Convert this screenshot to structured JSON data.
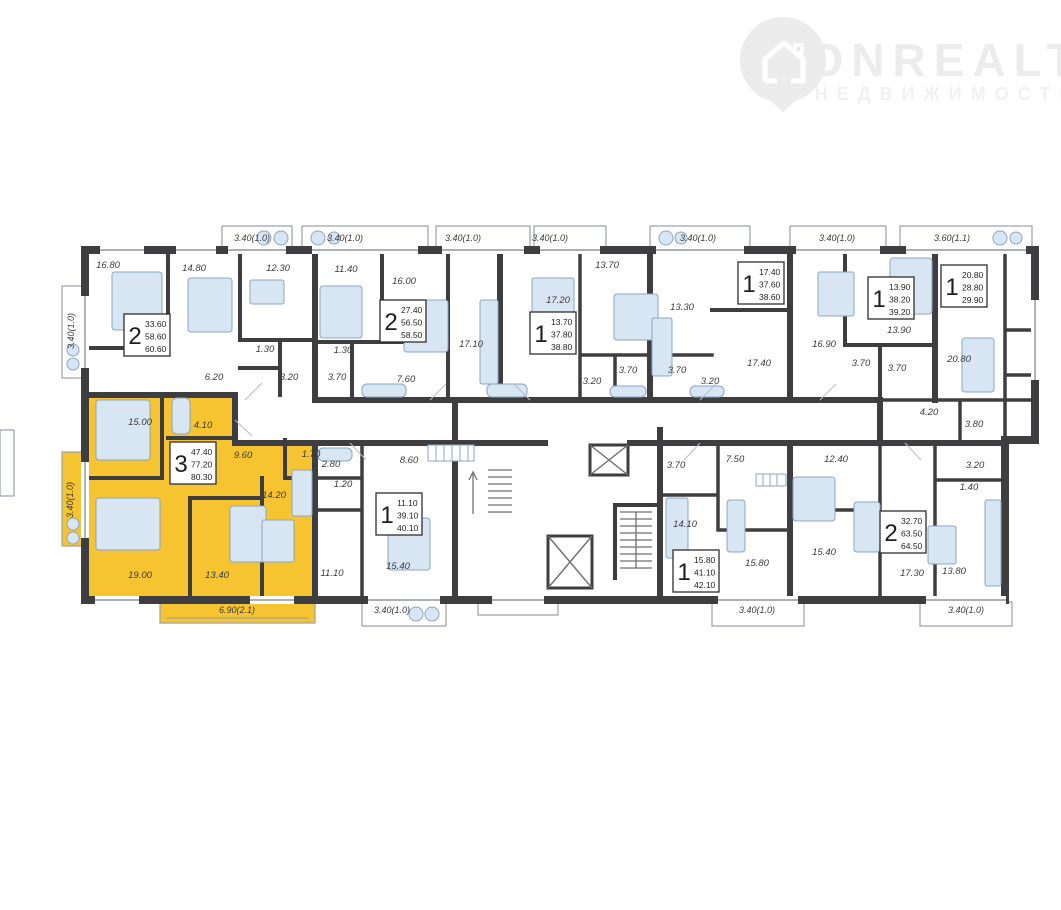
{
  "watermark": {
    "brand": "ONREALT",
    "subtitle": "НЕДВИЖИМОСТЬ",
    "icon": "house-pin-icon"
  },
  "palette": {
    "highlight": "#f6c331",
    "wall": "#3e3e40",
    "furniture_fill": "#d8e6f3",
    "furniture_stroke": "#8ba6c1",
    "label_color": "#3a3a3a",
    "watermark_color": "#ececec"
  },
  "highlighted_apartment": {
    "rooms": "3",
    "area_living": "47.40",
    "area_usable": "77.20",
    "area_total": "80.30",
    "balcony_dimension": "6.90(2.1)"
  },
  "apartment_tags": [
    {
      "n": "2",
      "a1": "33.60",
      "a2": "58.60",
      "a3": "60.60",
      "x": 124,
      "y": 314,
      "hl": false
    },
    {
      "n": "2",
      "a1": "27.40",
      "a2": "56.50",
      "a3": "58.50",
      "x": 380,
      "y": 300,
      "hl": false
    },
    {
      "n": "1",
      "a1": "13.70",
      "a2": "37.80",
      "a3": "38.80",
      "x": 530,
      "y": 312,
      "hl": false
    },
    {
      "n": "1",
      "a1": "17.40",
      "a2": "37.60",
      "a3": "38.60",
      "x": 738,
      "y": 262,
      "hl": false
    },
    {
      "n": "1",
      "a1": "13.90",
      "a2": "38.20",
      "a3": "39.20",
      "x": 868,
      "y": 277,
      "hl": false
    },
    {
      "n": "1",
      "a1": "20.80",
      "a2": "28.80",
      "a3": "29.90",
      "x": 941,
      "y": 265,
      "hl": false
    },
    {
      "n": "3",
      "a1": "47.40",
      "a2": "77.20",
      "a3": "80.30",
      "x": 170,
      "y": 442,
      "hl": true
    },
    {
      "n": "1",
      "a1": "11.10",
      "a2": "39.10",
      "a3": "40.10",
      "x": 376,
      "y": 493,
      "hl": false
    },
    {
      "n": "1",
      "a1": "15.80",
      "a2": "41.10",
      "a3": "42.10",
      "x": 673,
      "y": 550,
      "hl": false
    },
    {
      "n": "2",
      "a1": "32.70",
      "a2": "63.50",
      "a3": "64.50",
      "x": 880,
      "y": 511,
      "hl": false
    }
  ],
  "room_labels": [
    [
      "16.80",
      108,
      268
    ],
    [
      "14.80",
      194,
      271
    ],
    [
      "12.30",
      278,
      271
    ],
    [
      "11.40",
      346,
      272
    ],
    [
      "16.00",
      404,
      284
    ],
    [
      "17.10",
      471,
      347
    ],
    [
      "17.20",
      558,
      303
    ],
    [
      "13.70",
      607,
      268
    ],
    [
      "13.30",
      682,
      310
    ],
    [
      "17.40",
      759,
      366
    ],
    [
      "16.90",
      824,
      347
    ],
    [
      "13.90",
      899,
      333
    ],
    [
      "20.80",
      959,
      362
    ],
    [
      "6.20",
      214,
      380
    ],
    [
      "1.30",
      265,
      352
    ],
    [
      "3.20",
      289,
      380
    ],
    [
      "3.70",
      337,
      380
    ],
    [
      "1.30",
      343,
      353
    ],
    [
      "7.60",
      406,
      382
    ],
    [
      "3.20",
      592,
      384
    ],
    [
      "3.70",
      628,
      373
    ],
    [
      "3.70",
      677,
      373
    ],
    [
      "3.20",
      710,
      384
    ],
    [
      "3.70",
      861,
      366
    ],
    [
      "3.70",
      897,
      371
    ],
    [
      "4.20",
      929,
      415
    ],
    [
      "3.80",
      974,
      427
    ],
    [
      "15.00",
      140,
      425
    ],
    [
      "4.10",
      203,
      428
    ],
    [
      "9.60",
      243,
      458
    ],
    [
      "1.70",
      311,
      457
    ],
    [
      "14.20",
      274,
      498
    ],
    [
      "19.00",
      140,
      578
    ],
    [
      "13.40",
      217,
      578
    ],
    [
      "2.80",
      331,
      467
    ],
    [
      "1.20",
      343,
      487
    ],
    [
      "8.60",
      409,
      463
    ],
    [
      "11.10",
      332,
      576
    ],
    [
      "15.40",
      398,
      569
    ],
    [
      "3.70",
      676,
      468
    ],
    [
      "7.50",
      735,
      462
    ],
    [
      "14.10",
      685,
      527
    ],
    [
      "15.80",
      757,
      566
    ],
    [
      "12.40",
      836,
      462
    ],
    [
      "15.40",
      824,
      555
    ],
    [
      "3.20",
      975,
      468
    ],
    [
      "1.40",
      969,
      490
    ],
    [
      "17.30",
      912,
      576
    ],
    [
      "13.80",
      954,
      574
    ]
  ],
  "dimension_labels": [
    [
      "3.40(1.0)",
      252,
      241,
      0
    ],
    [
      "3.40(1.0)",
      345,
      241,
      0
    ],
    [
      "3.40(1.0)",
      463,
      241,
      0
    ],
    [
      "3.40(1.0)",
      550,
      241,
      0
    ],
    [
      "3.40(1.0)",
      698,
      241,
      0
    ],
    [
      "3.40(1.0)",
      837,
      241,
      0
    ],
    [
      "3.60(1.1)",
      952,
      241,
      0
    ],
    [
      "3.40(1.0)",
      74,
      331,
      -90
    ],
    [
      "3.40(1.0)",
      73,
      500,
      -90
    ],
    [
      "6.90(2.1)",
      237,
      613,
      0
    ],
    [
      "3.40(1.0)",
      392,
      613,
      0
    ],
    [
      "3.40(1.0)",
      757,
      613,
      0
    ],
    [
      "3.40(1.0)",
      966,
      613,
      0
    ]
  ]
}
